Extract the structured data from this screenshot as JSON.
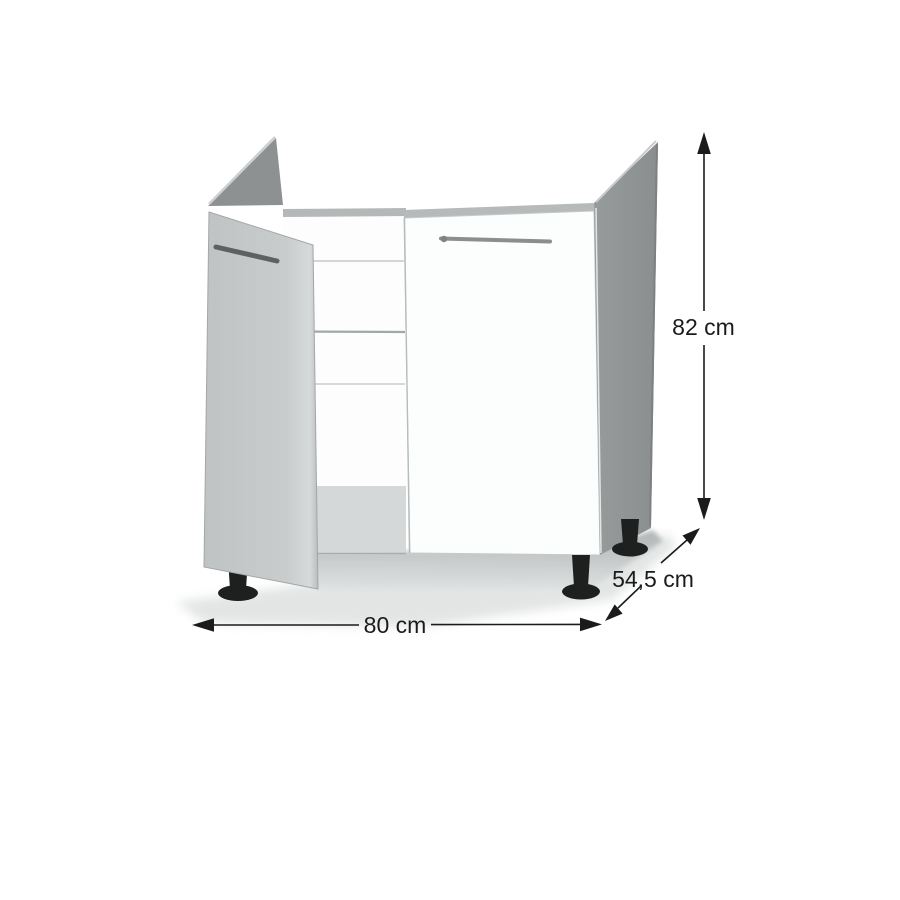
{
  "diagram": {
    "labels": {
      "height": "82 cm",
      "depth": "54,5 cm",
      "width": "80 cm"
    },
    "colors": {
      "background": "#ffffff",
      "open_door_gray": "#c6c9c9",
      "side_panel_gray": "#8f9393",
      "door_white": "#fcfdfd",
      "interior_bottom_gray": "#d5d8d8",
      "leg_black": "#1e2020",
      "dimension_line": "#1b1b1b"
    }
  }
}
